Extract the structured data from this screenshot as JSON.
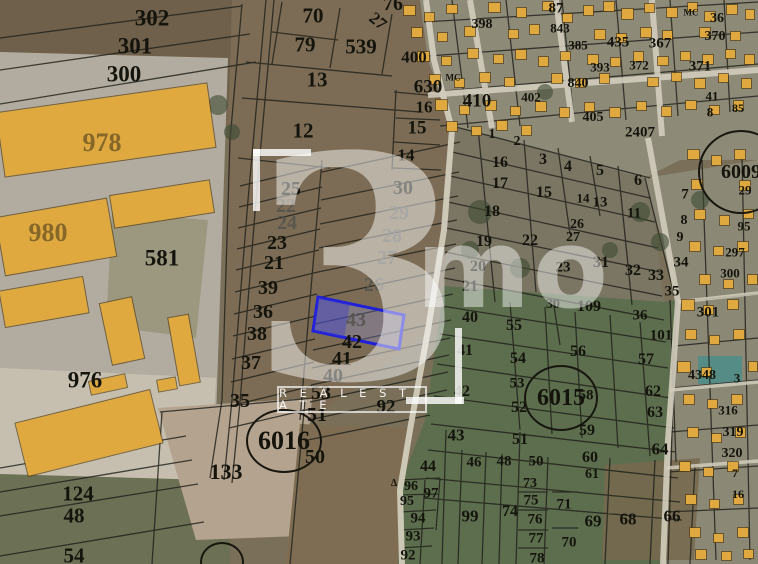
{
  "map": {
    "watermark": {
      "glyph": "3",
      "brand": "mo",
      "tagline": "R E A L  E S T A T E"
    },
    "highlight": {
      "parcel": "43",
      "stroke": "#2020d8",
      "fill": "rgba(140,150,240,0.28)",
      "fill_dark": "rgba(52,56,215,0.38)"
    },
    "colors": {
      "building": "#dfa93f",
      "building_stroke": "#5a4a1e",
      "line": "#21211a",
      "road": "#d2ccbc",
      "water_roof": "#4f8d88"
    },
    "circled": [
      {
        "t": "6016",
        "x": 284,
        "y": 441,
        "rx": 36,
        "ry": 30,
        "s": 26
      },
      {
        "t": "6015",
        "x": 561,
        "y": 398,
        "rx": 35,
        "ry": 31,
        "s": 24
      },
      {
        "t": "6009",
        "x": 741,
        "y": 172,
        "rx": 41,
        "ry": 40,
        "s": 20
      },
      {
        "t": "",
        "x": 222,
        "y": 562,
        "rx": 20,
        "ry": 18,
        "s": 0
      }
    ],
    "labels": [
      [
        "302",
        152,
        18,
        23
      ],
      [
        "301",
        135,
        46,
        23
      ],
      [
        "300",
        124,
        74,
        23
      ],
      [
        "978",
        102,
        143,
        26,
        "bld"
      ],
      [
        "980",
        48,
        233,
        26,
        "bld"
      ],
      [
        "581",
        162,
        258,
        23
      ],
      [
        "976",
        85,
        380,
        23
      ],
      [
        "124",
        78,
        494,
        21
      ],
      [
        "48",
        74,
        516,
        21
      ],
      [
        "54",
        74,
        556,
        21
      ],
      [
        "133",
        226,
        472,
        22
      ],
      [
        "70",
        313,
        16,
        21
      ],
      [
        "79",
        305,
        45,
        21
      ],
      [
        "539",
        361,
        47,
        21
      ],
      [
        "13",
        317,
        80,
        21
      ],
      [
        "76",
        393,
        4,
        20
      ],
      [
        "12",
        303,
        131,
        21
      ],
      [
        "27",
        378,
        21,
        17,
        null,
        40
      ],
      [
        "630",
        428,
        87,
        19
      ],
      [
        "410",
        477,
        101,
        19
      ],
      [
        "400",
        414,
        57,
        17
      ],
      [
        "16",
        424,
        107,
        17
      ],
      [
        "15",
        417,
        128,
        19
      ],
      [
        "14",
        406,
        155,
        17
      ],
      [
        "25",
        291,
        189,
        20
      ],
      [
        "22",
        286,
        206,
        20,
        "faded"
      ],
      [
        "24",
        287,
        223,
        20,
        "faded"
      ],
      [
        "23",
        277,
        243,
        20
      ],
      [
        "21",
        274,
        263,
        20
      ],
      [
        "39",
        268,
        288,
        20
      ],
      [
        "36",
        263,
        312,
        20
      ],
      [
        "38",
        257,
        334,
        20
      ],
      [
        "37",
        251,
        363,
        20
      ],
      [
        "35",
        240,
        401,
        20
      ],
      [
        "30",
        403,
        188,
        20
      ],
      [
        "29",
        399,
        213,
        20,
        "faded"
      ],
      [
        "28",
        392,
        236,
        20,
        "faded"
      ],
      [
        "27",
        387,
        258,
        20,
        "faded"
      ],
      [
        "26",
        374,
        285,
        20,
        "faded"
      ],
      [
        "43",
        356,
        320,
        20,
        "faded"
      ],
      [
        "42",
        352,
        342,
        20
      ],
      [
        "41",
        342,
        359,
        20
      ],
      [
        "40",
        333,
        376,
        20
      ],
      [
        "53",
        321,
        393,
        20
      ],
      [
        "51",
        317,
        415,
        20
      ],
      [
        "50",
        315,
        457,
        20
      ],
      [
        "92",
        386,
        407,
        19
      ],
      [
        "1",
        492,
        135,
        14
      ],
      [
        "2",
        517,
        142,
        14
      ],
      [
        "16",
        500,
        163,
        16
      ],
      [
        "3",
        543,
        160,
        16
      ],
      [
        "4",
        568,
        167,
        16
      ],
      [
        "5",
        600,
        171,
        16
      ],
      [
        "6",
        638,
        181,
        16
      ],
      [
        "17",
        500,
        184,
        16
      ],
      [
        "15",
        544,
        193,
        16
      ],
      [
        "14",
        583,
        198,
        13
      ],
      [
        "13",
        600,
        203,
        15
      ],
      [
        "11",
        634,
        214,
        15
      ],
      [
        "7",
        685,
        195,
        15
      ],
      [
        "18",
        492,
        212,
        16
      ],
      [
        "26",
        577,
        225,
        14
      ],
      [
        "27",
        573,
        238,
        14
      ],
      [
        "8",
        684,
        221,
        14
      ],
      [
        "9",
        680,
        238,
        14
      ],
      [
        "19",
        484,
        242,
        16
      ],
      [
        "22",
        530,
        241,
        16
      ],
      [
        "20",
        478,
        267,
        16
      ],
      [
        "23",
        563,
        268,
        15
      ],
      [
        "31",
        601,
        263,
        16
      ],
      [
        "32",
        633,
        271,
        16
      ],
      [
        "33",
        656,
        276,
        16
      ],
      [
        "34",
        681,
        263,
        15
      ],
      [
        "21",
        470,
        287,
        16
      ],
      [
        "30",
        553,
        305,
        14
      ],
      [
        "109",
        589,
        307,
        16
      ],
      [
        "35",
        672,
        292,
        15
      ],
      [
        "36",
        640,
        316,
        15
      ],
      [
        "101",
        661,
        336,
        15
      ],
      [
        "40",
        470,
        318,
        16
      ],
      [
        "55",
        514,
        326,
        16
      ],
      [
        "41",
        465,
        351,
        16
      ],
      [
        "54",
        518,
        359,
        16
      ],
      [
        "56",
        578,
        352,
        16
      ],
      [
        "57",
        646,
        360,
        16
      ],
      [
        "53",
        517,
        384,
        15
      ],
      [
        "42",
        462,
        392,
        16
      ],
      [
        "52",
        519,
        408,
        16
      ],
      [
        "58",
        586,
        396,
        15
      ],
      [
        "62",
        653,
        392,
        16
      ],
      [
        "63",
        655,
        413,
        16
      ],
      [
        "59",
        587,
        431,
        16
      ],
      [
        "64",
        660,
        449,
        17
      ],
      [
        "43",
        456,
        435,
        17
      ],
      [
        "51",
        520,
        440,
        16
      ],
      [
        "44",
        428,
        467,
        16
      ],
      [
        "46",
        474,
        463,
        15
      ],
      [
        "48",
        504,
        462,
        15
      ],
      [
        "50",
        536,
        462,
        15
      ],
      [
        "60",
        590,
        458,
        16
      ],
      [
        "61",
        592,
        475,
        14
      ],
      [
        "73",
        530,
        484,
        14
      ],
      [
        "75",
        531,
        501,
        15
      ],
      [
        "76",
        535,
        520,
        15
      ],
      [
        "77",
        536,
        539,
        15
      ],
      [
        "78",
        537,
        559,
        15
      ],
      [
        "71",
        564,
        505,
        15
      ],
      [
        "70",
        569,
        543,
        15
      ],
      [
        "74",
        510,
        512,
        16
      ],
      [
        "99",
        470,
        516,
        17
      ],
      [
        "69",
        593,
        521,
        17
      ],
      [
        "68",
        628,
        519,
        17
      ],
      [
        "66",
        672,
        516,
        17
      ],
      [
        "96",
        411,
        487,
        14
      ],
      [
        "97",
        431,
        494,
        15
      ],
      [
        "95",
        407,
        502,
        14
      ],
      [
        "94",
        418,
        519,
        15
      ],
      [
        "93",
        413,
        537,
        15
      ],
      [
        "92",
        408,
        556,
        15
      ],
      [
        "398",
        482,
        25,
        14
      ],
      [
        "87",
        556,
        9,
        15
      ],
      [
        "843",
        560,
        28,
        13
      ],
      [
        "385",
        578,
        45,
        13
      ],
      [
        "435",
        618,
        43,
        15
      ],
      [
        "367",
        660,
        44,
        15
      ],
      [
        "36",
        717,
        19,
        14
      ],
      [
        "370",
        715,
        37,
        14
      ],
      [
        "372",
        639,
        65,
        13
      ],
      [
        "371",
        700,
        67,
        15
      ],
      [
        "393",
        600,
        67,
        13
      ],
      [
        "840",
        578,
        84,
        14
      ],
      [
        "402",
        531,
        97,
        13
      ],
      [
        "405",
        593,
        118,
        14
      ],
      [
        "2407",
        640,
        133,
        15
      ],
      [
        "41",
        712,
        96,
        13
      ],
      [
        "8",
        710,
        112,
        13
      ],
      [
        "85",
        738,
        108,
        12
      ],
      [
        "МС",
        453,
        78,
        9
      ],
      [
        "МС",
        691,
        13,
        9
      ],
      [
        "29",
        745,
        190,
        13
      ],
      [
        "95",
        744,
        226,
        13
      ],
      [
        "297",
        735,
        252,
        13
      ],
      [
        "300",
        730,
        273,
        13
      ],
      [
        "301",
        708,
        313,
        15
      ],
      [
        "4348",
        702,
        376,
        14
      ],
      [
        "3",
        737,
        378,
        13
      ],
      [
        "316",
        728,
        410,
        13
      ],
      [
        "319",
        733,
        433,
        14
      ],
      [
        "320",
        732,
        454,
        14
      ],
      [
        "7",
        735,
        473,
        12
      ],
      [
        "16",
        738,
        494,
        12
      ],
      [
        "Δ",
        394,
        484,
        10
      ]
    ],
    "buildings": [
      [
        0,
        98,
        212,
        64,
        -8
      ],
      [
        112,
        188,
        100,
        32,
        -9
      ],
      [
        0,
        208,
        112,
        58,
        -10
      ],
      [
        2,
        284,
        84,
        36,
        -10
      ],
      [
        106,
        300,
        32,
        62,
        -12
      ],
      [
        174,
        316,
        20,
        68,
        -10
      ],
      [
        20,
        406,
        138,
        54,
        -14
      ],
      [
        90,
        378,
        36,
        13,
        -12
      ],
      [
        158,
        379,
        18,
        11,
        -10
      ]
    ],
    "buildings_small": [
      [
        404,
        6,
        11,
        9
      ],
      [
        425,
        13,
        9,
        8
      ],
      [
        447,
        5,
        10,
        8
      ],
      [
        489,
        3,
        11,
        9
      ],
      [
        517,
        8,
        9,
        9
      ],
      [
        543,
        2,
        10,
        8
      ],
      [
        563,
        14,
        9,
        8
      ],
      [
        584,
        6,
        9,
        9
      ],
      [
        604,
        2,
        10,
        9
      ],
      [
        622,
        9,
        11,
        10
      ],
      [
        645,
        4,
        9,
        8
      ],
      [
        667,
        8,
        10,
        9
      ],
      [
        688,
        3,
        9,
        8
      ],
      [
        705,
        12,
        10,
        9
      ],
      [
        727,
        5,
        10,
        9
      ],
      [
        746,
        10,
        8,
        9
      ],
      [
        412,
        28,
        10,
        9
      ],
      [
        438,
        33,
        9,
        8
      ],
      [
        465,
        27,
        10,
        9
      ],
      [
        509,
        30,
        9,
        8
      ],
      [
        530,
        25,
        9,
        9
      ],
      [
        595,
        30,
        10,
        9
      ],
      [
        617,
        34,
        9,
        8
      ],
      [
        641,
        28,
        10,
        9
      ],
      [
        663,
        31,
        9,
        8
      ],
      [
        700,
        28,
        10,
        9
      ],
      [
        731,
        32,
        9,
        8
      ],
      [
        418,
        52,
        11,
        9
      ],
      [
        442,
        57,
        9,
        8
      ],
      [
        468,
        49,
        10,
        9
      ],
      [
        494,
        55,
        9,
        8
      ],
      [
        516,
        50,
        10,
        9
      ],
      [
        539,
        57,
        9,
        9
      ],
      [
        561,
        52,
        9,
        8
      ],
      [
        588,
        55,
        10,
        9
      ],
      [
        611,
        58,
        9,
        8
      ],
      [
        634,
        52,
        9,
        9
      ],
      [
        658,
        57,
        10,
        8
      ],
      [
        681,
        52,
        9,
        8
      ],
      [
        703,
        55,
        10,
        9
      ],
      [
        726,
        50,
        9,
        8
      ],
      [
        745,
        55,
        9,
        9
      ],
      [
        430,
        75,
        10,
        9
      ],
      [
        455,
        79,
        9,
        8
      ],
      [
        480,
        73,
        10,
        9
      ],
      [
        505,
        78,
        9,
        8
      ],
      [
        552,
        74,
        10,
        9
      ],
      [
        576,
        79,
        9,
        8
      ],
      [
        600,
        74,
        9,
        9
      ],
      [
        648,
        78,
        10,
        8
      ],
      [
        672,
        73,
        9,
        8
      ],
      [
        695,
        79,
        10,
        9
      ],
      [
        719,
        74,
        9,
        8
      ],
      [
        742,
        79,
        9,
        9
      ],
      [
        436,
        100,
        11,
        10
      ],
      [
        460,
        106,
        9,
        8
      ],
      [
        486,
        101,
        10,
        9
      ],
      [
        511,
        107,
        9,
        8
      ],
      [
        536,
        102,
        10,
        9
      ],
      [
        560,
        108,
        9,
        9
      ],
      [
        585,
        103,
        9,
        8
      ],
      [
        610,
        108,
        10,
        9
      ],
      [
        637,
        102,
        9,
        8
      ],
      [
        662,
        107,
        9,
        9
      ],
      [
        686,
        101,
        10,
        8
      ],
      [
        710,
        106,
        9,
        8
      ],
      [
        734,
        101,
        9,
        9
      ],
      [
        447,
        122,
        10,
        9
      ],
      [
        472,
        127,
        9,
        8
      ],
      [
        497,
        121,
        10,
        9
      ],
      [
        522,
        126,
        9,
        9
      ],
      [
        688,
        150,
        11,
        9
      ],
      [
        712,
        156,
        9,
        9
      ],
      [
        735,
        150,
        10,
        9
      ],
      [
        692,
        180,
        10,
        9
      ],
      [
        740,
        181,
        10,
        9
      ],
      [
        695,
        210,
        10,
        9
      ],
      [
        720,
        216,
        9,
        9
      ],
      [
        744,
        210,
        9,
        8
      ],
      [
        690,
        242,
        10,
        9
      ],
      [
        714,
        247,
        9,
        8
      ],
      [
        738,
        242,
        10,
        9
      ],
      [
        700,
        275,
        10,
        9
      ],
      [
        724,
        280,
        9,
        8
      ],
      [
        748,
        275,
        9,
        9
      ],
      [
        682,
        300,
        12,
        10
      ],
      [
        704,
        306,
        9,
        8
      ],
      [
        728,
        300,
        10,
        9
      ],
      [
        686,
        330,
        10,
        9
      ],
      [
        710,
        336,
        9,
        8
      ],
      [
        734,
        330,
        10,
        9
      ],
      [
        678,
        362,
        12,
        10
      ],
      [
        702,
        368,
        9,
        8
      ],
      [
        749,
        362,
        8,
        9
      ],
      [
        684,
        395,
        10,
        9
      ],
      [
        708,
        400,
        9,
        8
      ],
      [
        732,
        395,
        10,
        9
      ],
      [
        688,
        428,
        10,
        9
      ],
      [
        712,
        434,
        9,
        8
      ],
      [
        736,
        428,
        9,
        9
      ],
      [
        680,
        462,
        10,
        9
      ],
      [
        704,
        468,
        9,
        8
      ],
      [
        728,
        462,
        10,
        9
      ],
      [
        686,
        495,
        10,
        9
      ],
      [
        710,
        500,
        9,
        8
      ],
      [
        734,
        495,
        9,
        9
      ],
      [
        690,
        528,
        10,
        9
      ],
      [
        714,
        534,
        9,
        8
      ],
      [
        738,
        528,
        10,
        9
      ],
      [
        696,
        550,
        10,
        9
      ],
      [
        722,
        552,
        9,
        8
      ],
      [
        744,
        550,
        9,
        8
      ]
    ]
  }
}
